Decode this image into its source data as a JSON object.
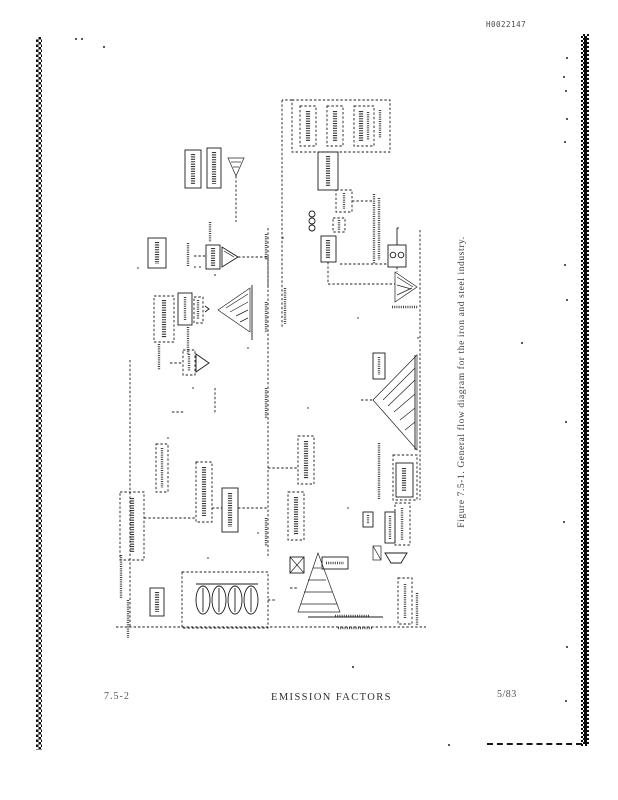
{
  "page": {
    "background": "#ffffff",
    "ink_color": "#1b1b1b",
    "scan_code": "H0022147",
    "figure": {
      "caption": "Figure 7.5-1.  General flow diagram for the iron and steel industry."
    },
    "footer": {
      "page_number": "7.5-2",
      "title": "EMISSION FACTORS",
      "revision_date": "5/83"
    }
  }
}
